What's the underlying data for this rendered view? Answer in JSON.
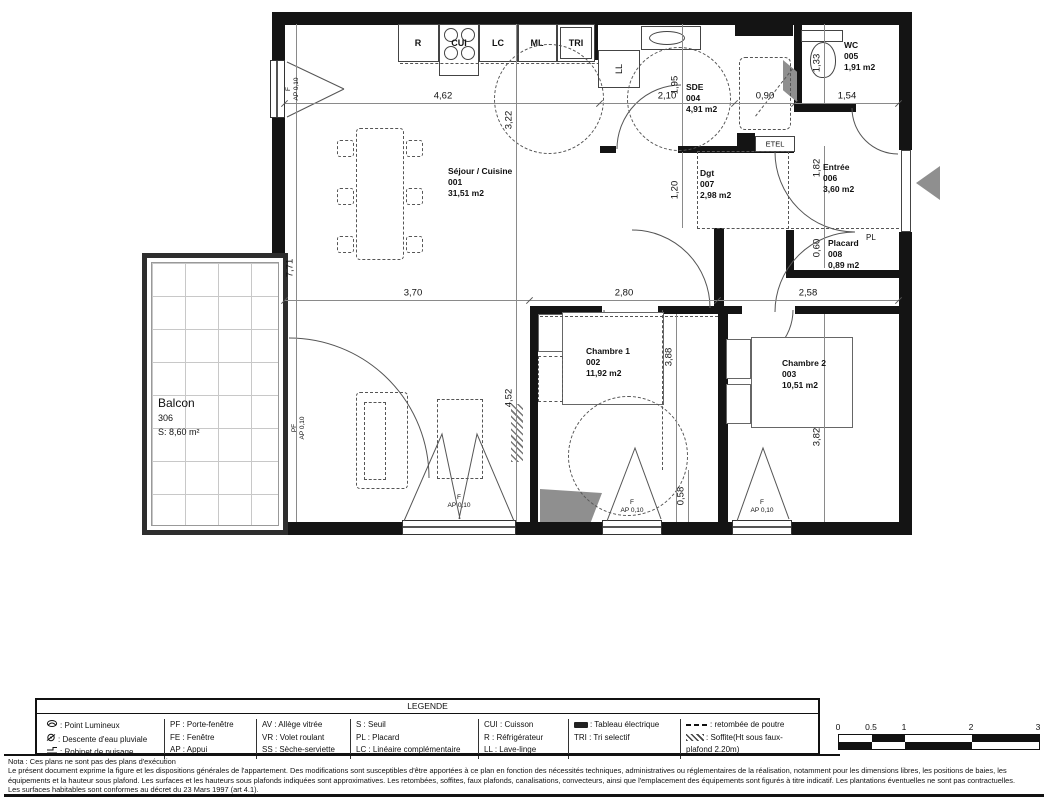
{
  "rooms": {
    "sejour": {
      "name": "Séjour / Cuisine",
      "num": "001",
      "area": "31,51 m2"
    },
    "chambre1": {
      "name": "Chambre 1",
      "num": "002",
      "area": "11,92 m2"
    },
    "chambre2": {
      "name": "Chambre 2",
      "num": "003",
      "area": "10,51 m2"
    },
    "sde": {
      "name": "SDE",
      "num": "004",
      "area": "4,91 m2"
    },
    "wc": {
      "name": "WC",
      "num": "005",
      "area": "1,91 m2"
    },
    "entree": {
      "name": "Entrée",
      "num": "006",
      "area": "3,60 m2"
    },
    "dgt": {
      "name": "Dgt",
      "num": "007",
      "area": "2,98 m2"
    },
    "placard": {
      "name": "Placard",
      "num": "008",
      "area": "0,89 m2"
    },
    "balcon": {
      "name": "Balcon",
      "num": "306",
      "area": "S: 8,60 m²"
    }
  },
  "appliances": {
    "r": "R",
    "cui": "CUI",
    "lc": "LC",
    "ml": "ML",
    "tri": "TRI",
    "ll": "LL",
    "etel": "ETEL",
    "pl": "PL"
  },
  "window": {
    "f": "F",
    "pf": "PF",
    "ap": "AP 0,10"
  },
  "dims": {
    "h462": "4,62",
    "h210": "2,10",
    "h090": "0,90",
    "h154": "1,54",
    "h370": "3,70",
    "h280": "2,80",
    "h258": "2,58",
    "v771": "7,71",
    "v322": "3,22",
    "v452": "4,52",
    "v195": "1,95",
    "v120": "1,20",
    "v388": "3,88",
    "v058": "0,58",
    "v133": "1,33",
    "v182": "1,82",
    "v060": "0,60",
    "v382": "3,82"
  },
  "legend": {
    "title": "LEGENDE",
    "col1": [
      ": Point Lumineux",
      ": Descente d'eau pluviale",
      ": Robinet de puisage"
    ],
    "col2": [
      "PF : Porte-fenêtre",
      "FE : Fenêtre",
      "AP : Appui"
    ],
    "col3": [
      "AV : Allège vitrée",
      "VR : Volet roulant",
      "SS : Sèche-serviette"
    ],
    "col4": [
      "S : Seuil",
      "PL : Placard",
      "LC : Linéaire complémentaire"
    ],
    "col5": [
      "CUI : Cuisson",
      "R : Réfrigérateur",
      "LL : Lave-linge"
    ],
    "col6": [
      ": Tableau électrique",
      "TRI : Tri selectif"
    ],
    "col7": [
      ": retombée de poutre",
      ": Soffite(Ht sous faux-plafond 2.20m)"
    ]
  },
  "notes": {
    "l1": "Nota : Ces plans ne sont pas des plans d'exécution",
    "l2": "Le présent document exprime la figure et les dispositions générales de l'appartement. Des modifications sont susceptibles d'être apportées à ce plan en fonction des nécessités techniques, administratives ou réglementaires de la réalisation, notamment pour les dimensions libres, les positions de baies, les",
    "l3": "équipements et la hauteur sous plafond. Les surfaces et les hauteurs sous plafonds indiquées sont approximatives. Les retombées, soffites, faux plafonds, canalisations, convecteurs, ainsi que l'emplacement des équipements sont figurés à titre indicatif. Les plantations éventuelles ne sont pas contractuelles.",
    "l4": "Les surfaces habitables sont conformes au décret du 23 Mars 1997 (art 4.1)."
  },
  "scalebar": {
    "t0": "0",
    "t05": "0.5",
    "t1": "1",
    "t2": "2",
    "t3": "3"
  },
  "colors": {
    "wall": "#141414",
    "line": "#555555",
    "gray": "#8f8f8f"
  }
}
